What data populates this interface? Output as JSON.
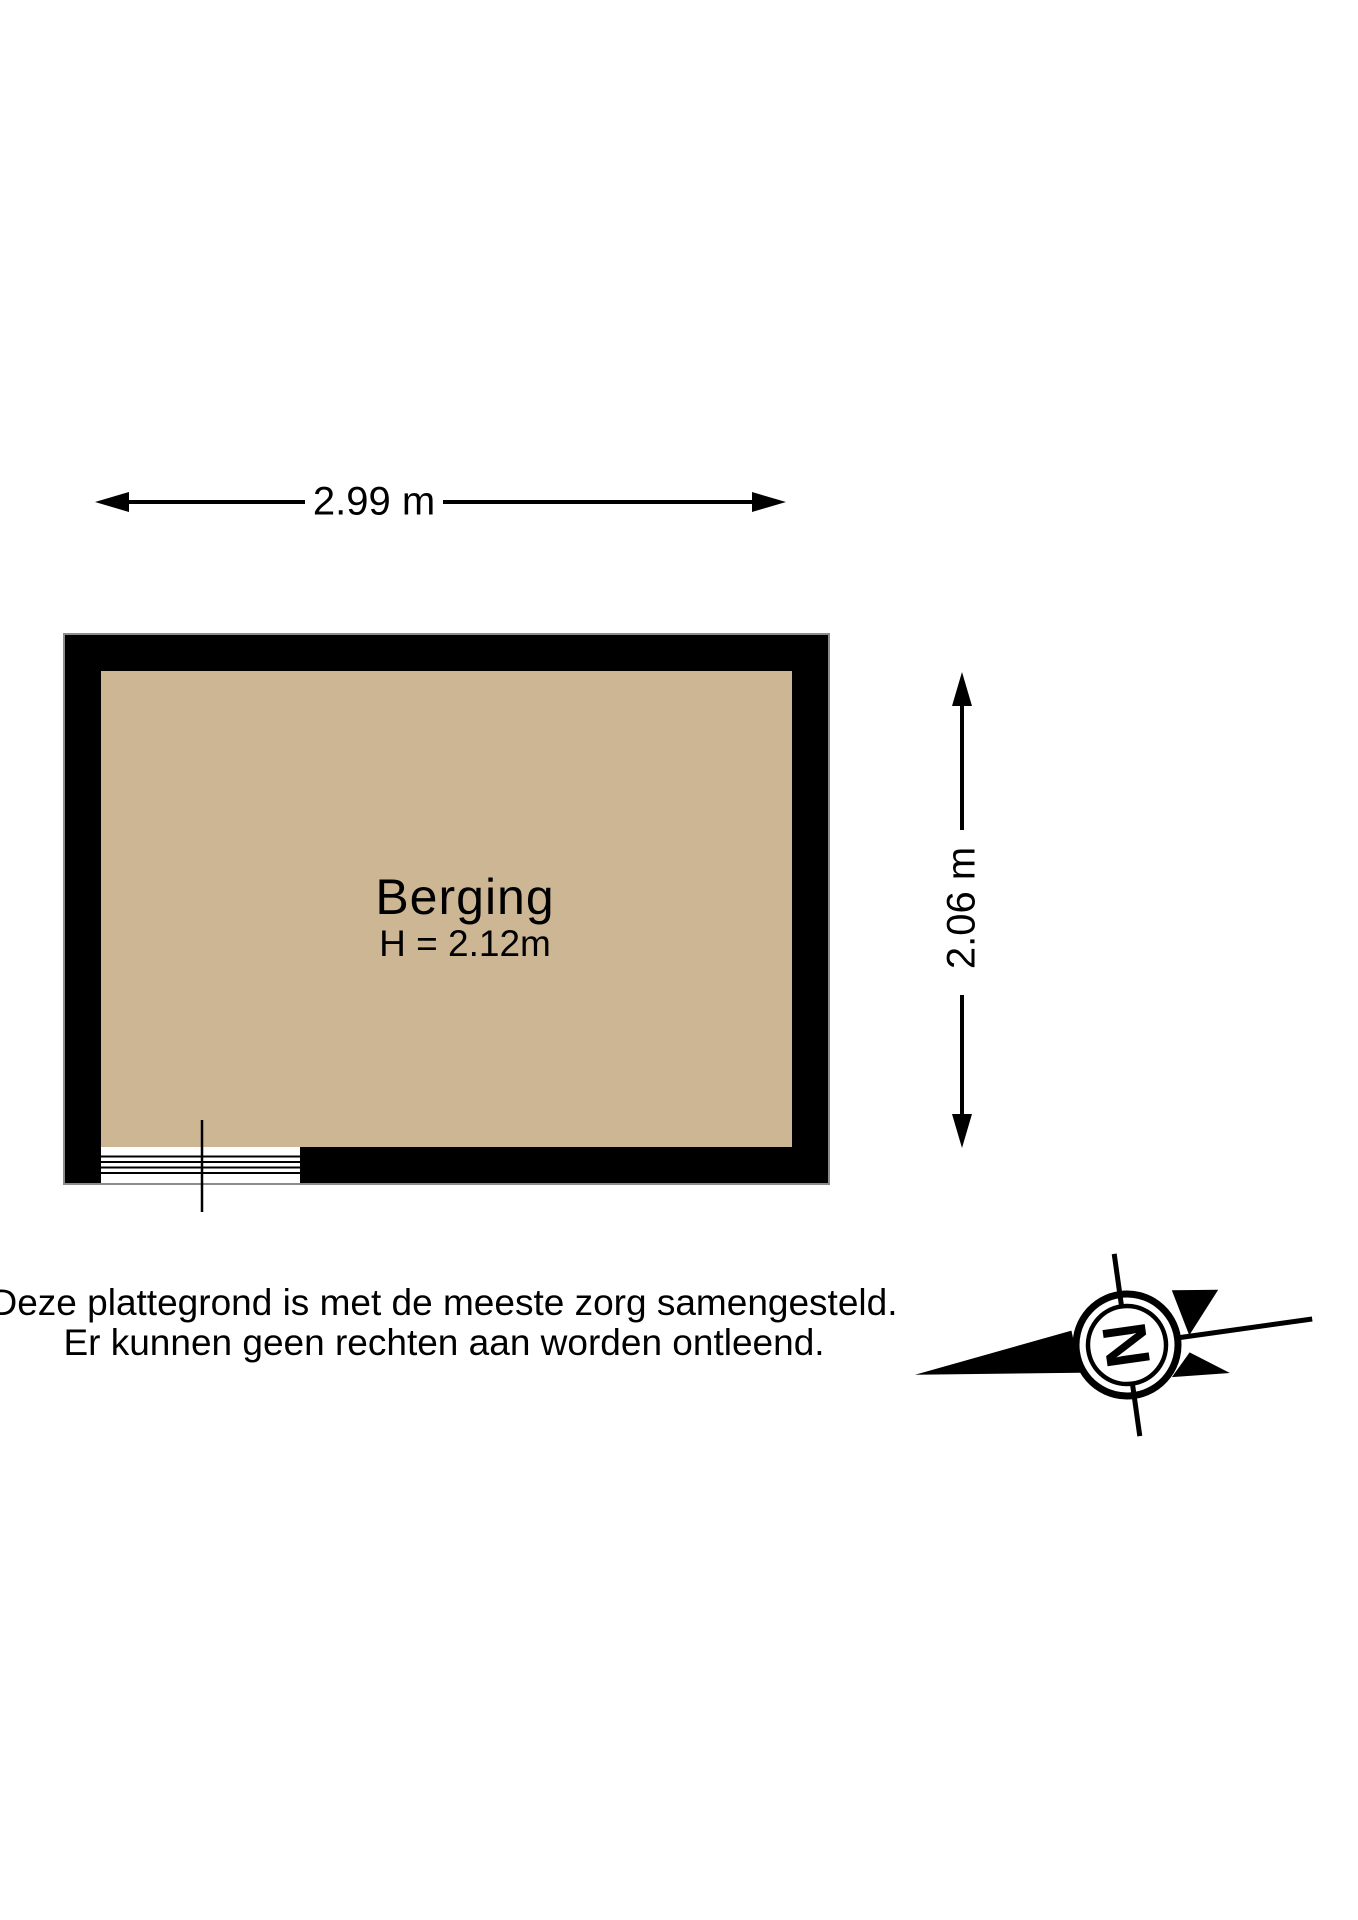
{
  "dimensions": {
    "width_label": "2.99 m",
    "height_label": "2.06 m"
  },
  "room": {
    "name": "Berging",
    "ceiling_height_label": "H = 2.12m"
  },
  "disclaimer": {
    "line1": "Deze plattegrond is met de meeste zorg samengesteld.",
    "line2": "Er kunnen geen rechten aan worden ontleend."
  },
  "compass": {
    "north_letter": "N"
  },
  "colors": {
    "background": "#ffffff",
    "wall": "#000000",
    "wall_outline": "#8c8c8c",
    "floor": "#cdb694",
    "lines_and_text": "#000000"
  }
}
